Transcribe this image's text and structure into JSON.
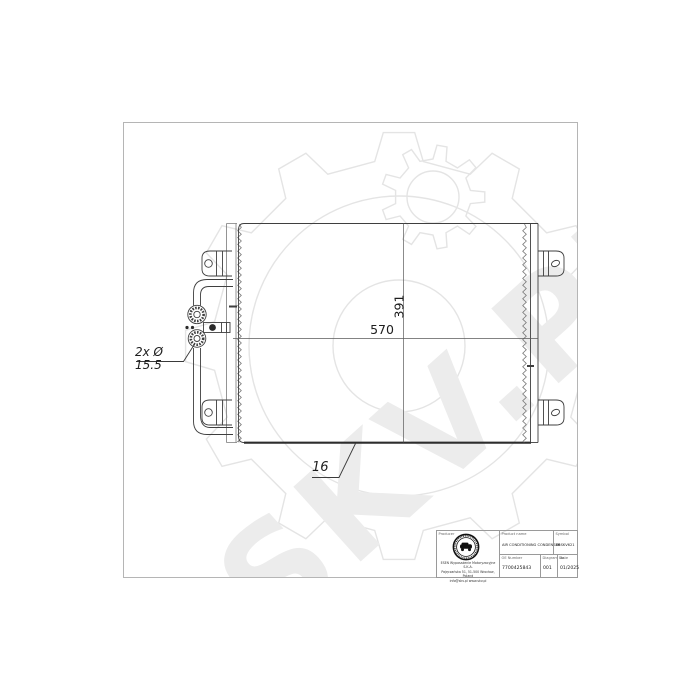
{
  "watermark": {
    "text": "SKV.PL"
  },
  "annotations": {
    "width_mm": "570",
    "height_mm": "391",
    "depth_note": "16",
    "ports_note": "2x Ø 15.5"
  },
  "title_block": {
    "producer_label": "Producer",
    "company_lines": [
      "ESEN Wyposażenie Motoryzacyjne S.K.A.",
      "Pajęczańska 51, 51-500 Wrocław, Poland",
      "info@skv.pl   www.skv.pl"
    ],
    "product_name_label": "Product name",
    "product_name": "AIR CONDITIONING CONDENSER",
    "symbol_label": "Symbol",
    "symbol": "86SKV621",
    "oe_number_label": "OE Number",
    "oe_number": "7700425843",
    "diagram_label": "Diagram No.",
    "diagram_no": "001",
    "date_label": "Date",
    "date": "01/2025"
  },
  "colors": {
    "line": "#3f3f3f",
    "dimension": "#5a5a5a",
    "frame_border": "#b5b5b5",
    "watermark": "#ececec",
    "background": "#ffffff"
  }
}
